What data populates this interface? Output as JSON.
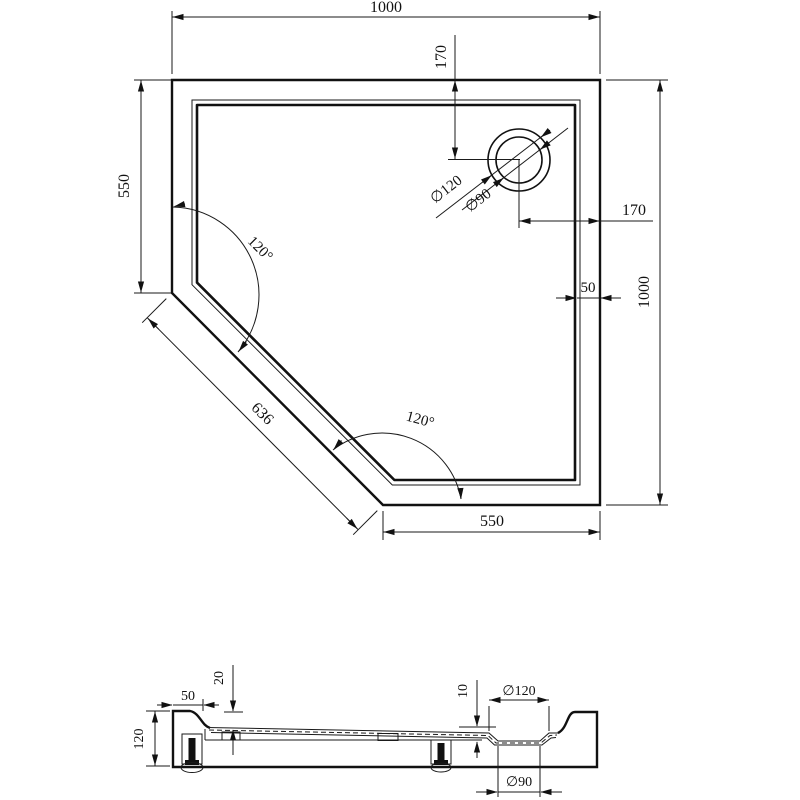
{
  "drawing": {
    "top_view": {
      "overall_width": "1000",
      "overall_height": "1000",
      "left_edge": "550",
      "bottom_edge": "550",
      "chamfer_length": "636",
      "drain_from_top": "170",
      "drain_from_right": "170",
      "wall_thickness": "50",
      "angle_upper": "120°",
      "angle_lower": "120°",
      "drain_outer_diameter": "∅120",
      "drain_inner_diameter": "∅90"
    },
    "section_view": {
      "rim_width": "50",
      "rim_depth": "20",
      "total_height": "120",
      "recess_depth": "10",
      "recess_outer_diameter": "∅120",
      "recess_inner_diameter": "∅90"
    },
    "line_color": "#111111",
    "background_color": "#ffffff"
  }
}
